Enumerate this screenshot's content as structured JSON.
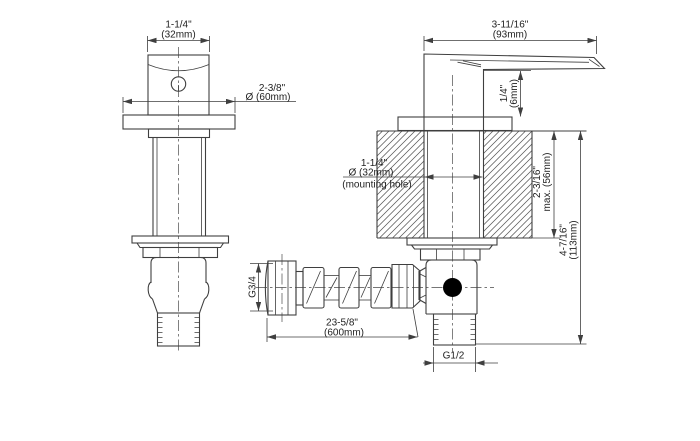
{
  "drawing": {
    "background": "#ffffff",
    "line_color": "#3f3f3f",
    "text_color": "#222222",
    "port_dot_color": "#000000",
    "views": {
      "front": "valve front view",
      "side": "valve side section view with mounting wall",
      "hose": "flexible supply hose"
    },
    "dimensions": {
      "handle_width": {
        "value": "1-1/4\"",
        "metric": "(32mm)"
      },
      "escutcheon_diameter": {
        "value": "2-3/8\"",
        "metric": "Ø (60mm)"
      },
      "lever_length": {
        "value": "3-11/16\"",
        "metric": "(93mm)"
      },
      "lever_clearance": {
        "value": "1/4\"",
        "metric": "(6mm)"
      },
      "mounting_hole": {
        "value": "1-1/4\"",
        "metric": "Ø (32mm)",
        "note": "(mounting hole)"
      },
      "wall_depth": {
        "value": "2-3/16\"",
        "metric": "max. (56mm)"
      },
      "overall_depth": {
        "value": "4-7/16\"",
        "metric": "(113mm)"
      },
      "hose_nut_thread": {
        "value": "G3/4"
      },
      "hose_length": {
        "value": "23-5/8\"",
        "metric": "(600mm)"
      },
      "outlet_thread": {
        "value": "G1/2"
      }
    }
  }
}
